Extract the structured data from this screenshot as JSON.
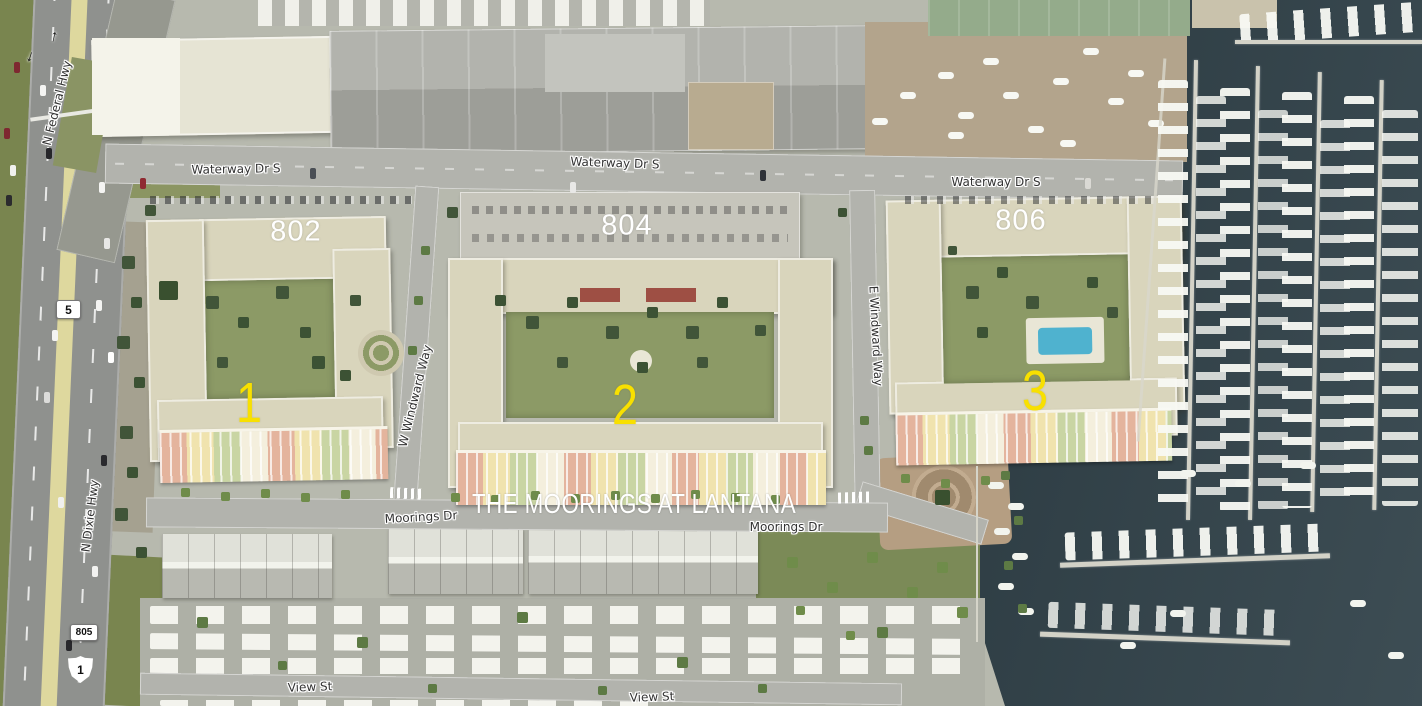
{
  "map": {
    "title_overlay": {
      "text": "THE MOORINGS AT LANTANA",
      "color": "#ffffff"
    },
    "building_numbers": [
      {
        "id": "building-802",
        "text": "802"
      },
      {
        "id": "building-804",
        "text": "804"
      },
      {
        "id": "building-806",
        "text": "806"
      }
    ],
    "phase_numbers": [
      {
        "id": "phase-1",
        "text": "1"
      },
      {
        "id": "phase-2",
        "text": "2"
      },
      {
        "id": "phase-3",
        "text": "3"
      }
    ],
    "street_labels": [
      {
        "id": "n-federal-hwy",
        "text": "N Federal Hwy"
      },
      {
        "id": "waterway-dr-s-west",
        "text": "Waterway Dr S"
      },
      {
        "id": "waterway-dr-s-mid",
        "text": "Waterway Dr S"
      },
      {
        "id": "waterway-dr-s-east",
        "text": "Waterway Dr S"
      },
      {
        "id": "w-windward-way",
        "text": "W Windward Way"
      },
      {
        "id": "e-windward-way",
        "text": "E Windward Way"
      },
      {
        "id": "n-dixie-hwy",
        "text": "N Dixie Hwy"
      },
      {
        "id": "moorings-dr-west",
        "text": "Moorings Dr"
      },
      {
        "id": "moorings-dr-east",
        "text": "Moorings Dr"
      },
      {
        "id": "view-st-west",
        "text": "View St"
      },
      {
        "id": "view-st-east",
        "text": "View St"
      }
    ],
    "route_shields": [
      {
        "id": "route-5",
        "text": "5",
        "shape": "rounded-rect"
      },
      {
        "id": "route-805",
        "text": "805",
        "shape": "rounded-rect"
      },
      {
        "id": "route-1",
        "text": "1",
        "shape": "us-route-shield"
      }
    ],
    "icons": [
      {
        "id": "lane-arrow-north",
        "glyph": "↑"
      },
      {
        "id": "lane-arrow-south",
        "glyph": "↓"
      }
    ],
    "colors": {
      "water": "#34444a",
      "street_label_text": "#333333",
      "street_label_halo": "#ffffff",
      "overlay_text": "#ffffff",
      "phase_text": "#f8e000"
    }
  }
}
